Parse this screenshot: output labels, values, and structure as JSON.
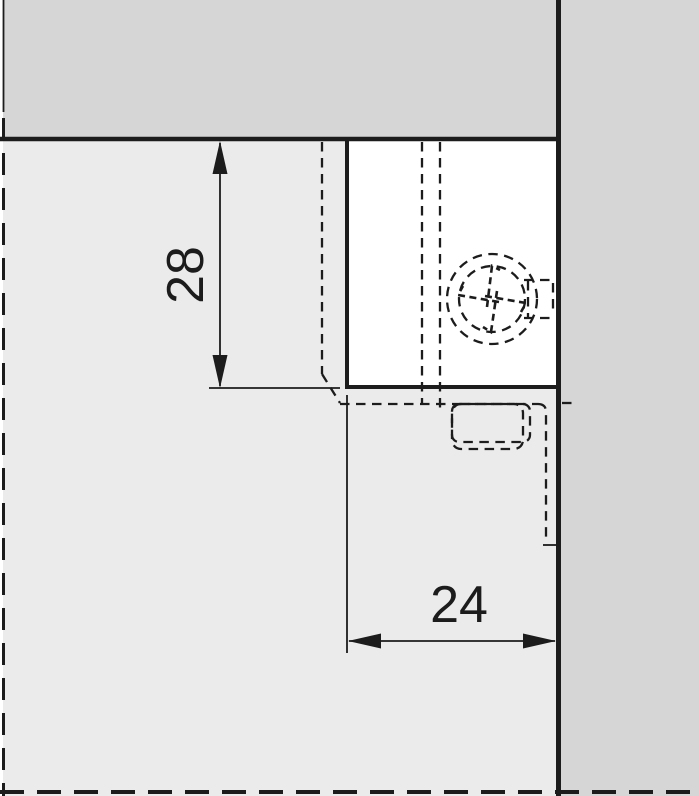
{
  "drawing": {
    "title": "hinge-mounting-drilling-diagram",
    "dimensions": {
      "vertical": {
        "value": "28"
      },
      "horizontal": {
        "value": "24"
      }
    },
    "icons": {
      "screw": "pozidriv-screw-head-icon"
    },
    "colors": {
      "panel_dark": "#d6d6d6",
      "panel_light": "#ebebeb",
      "cutout_white": "#ffffff",
      "line_color": "#1c1c1c",
      "page_bg": "#ffffff"
    }
  }
}
